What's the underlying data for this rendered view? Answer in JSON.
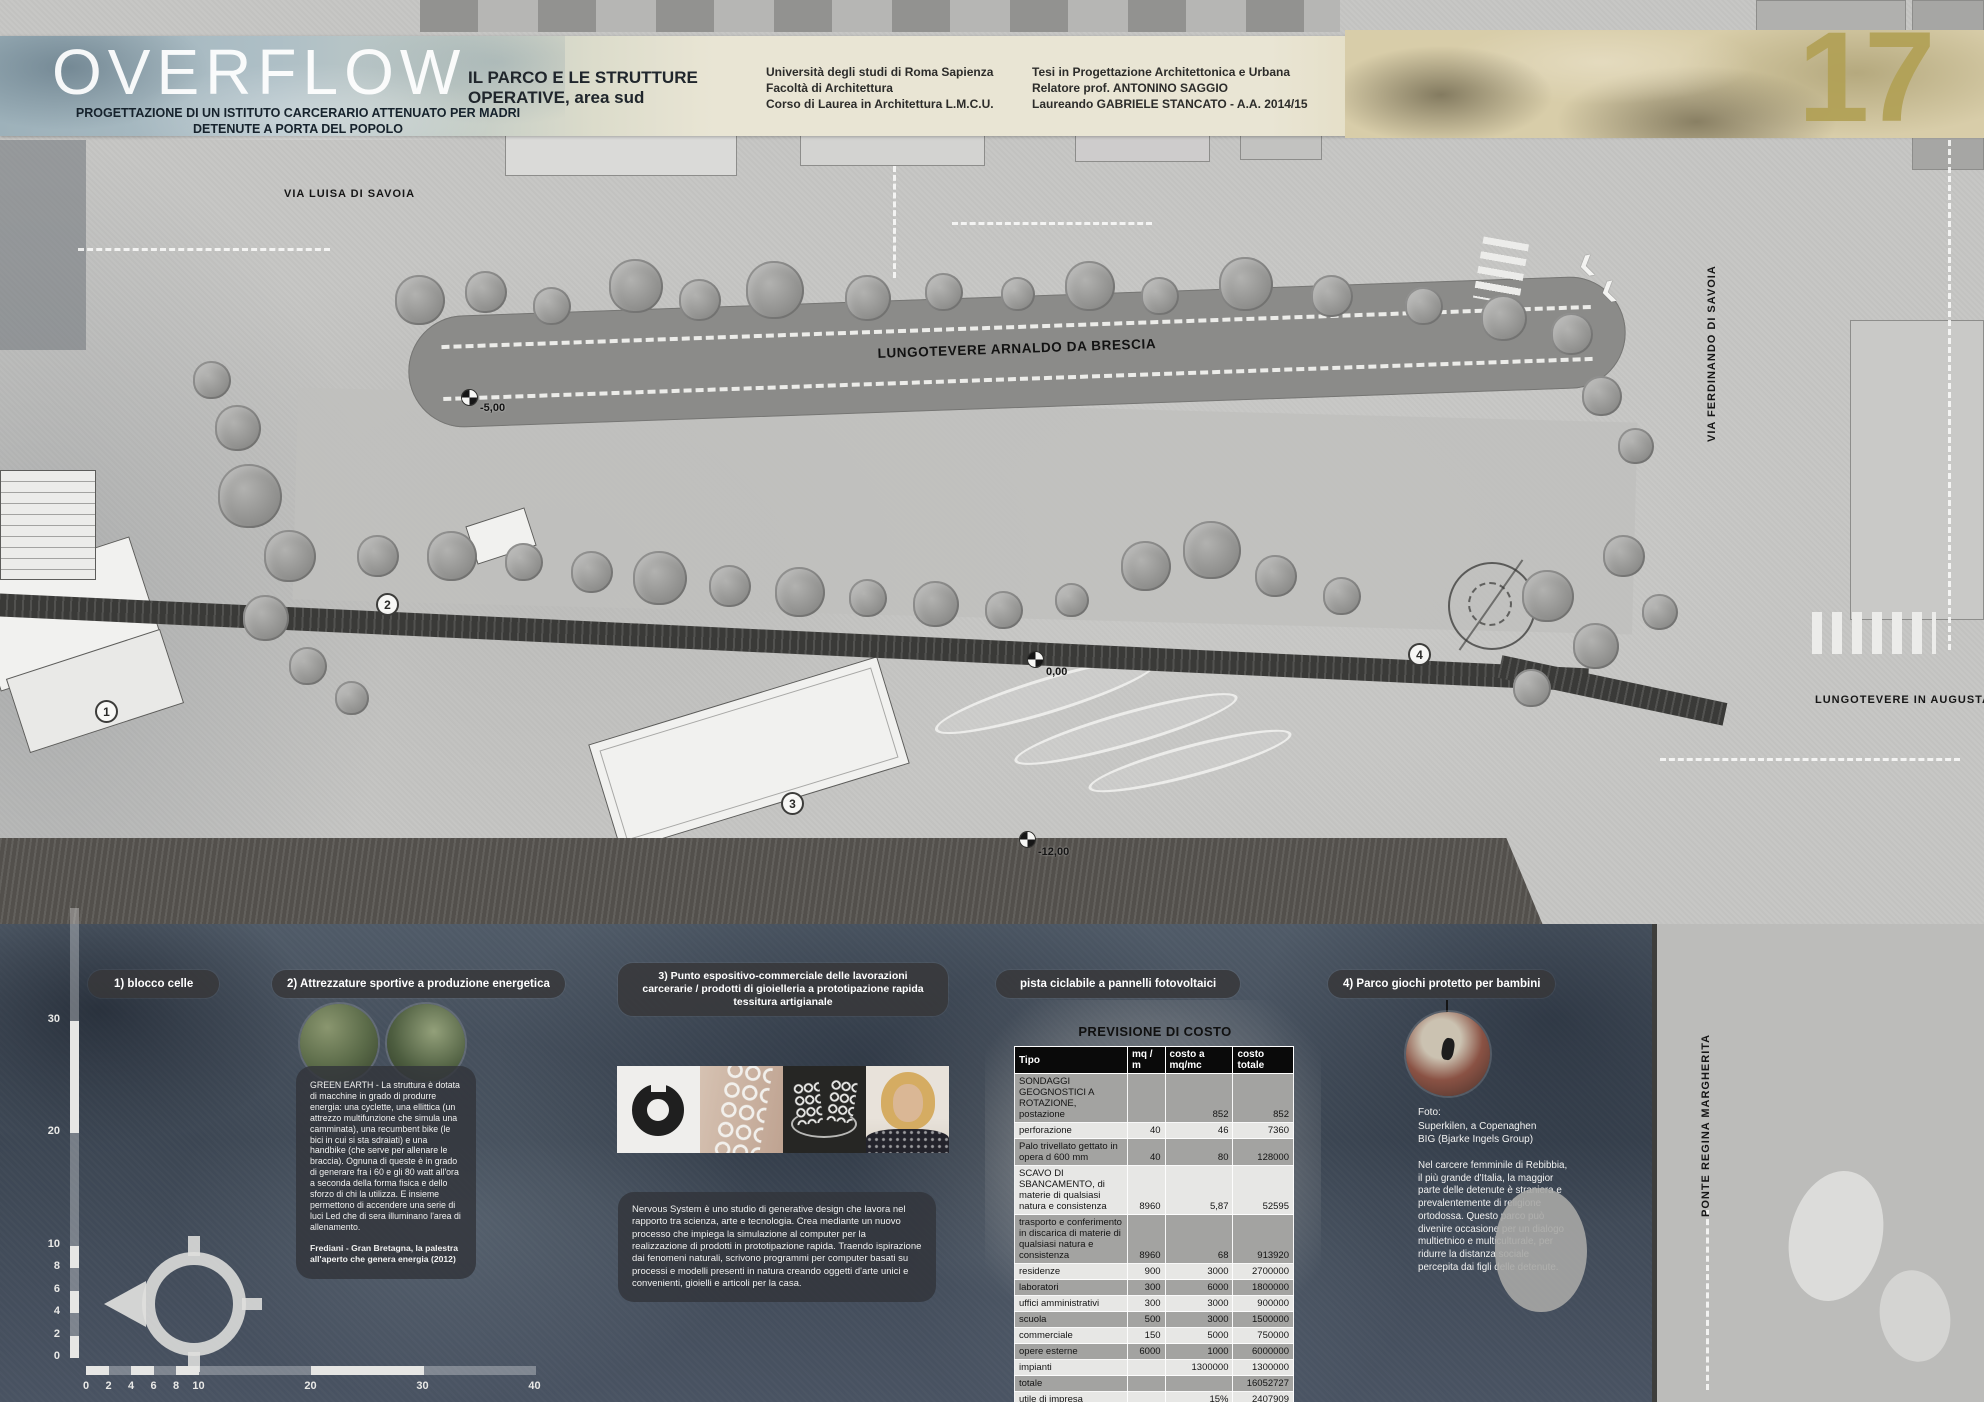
{
  "header": {
    "title": "OVERFLOW",
    "subtitle": "PROGETTAZIONE DI UN ISTITUTO CARCERARIO ATTENUATO PER MADRI DETENUTE A PORTA DEL POPOLO",
    "section_line1": "IL PARCO E LE STRUTTURE",
    "section_line2": "OPERATIVE, area sud",
    "university": [
      "Università degli studi di Roma Sapienza",
      "Facoltà di Architettura",
      "Corso di Laurea in Architettura L.M.C.U."
    ],
    "thesis": [
      "Tesi in Progettazione Architettonica e Urbana",
      "Relatore prof. ANTONINO SAGGIO",
      "Laureando GABRIELE STANCATO - A.A. 2014/15"
    ],
    "page_number": "17",
    "accent_gold": "#b2a156"
  },
  "plan": {
    "streets": {
      "via_luisa": "VIA LUISA DI SAVOIA",
      "lungotevere_brescia": "LUNGOTEVERE ARNALDO DA BRESCIA",
      "via_ferdinando": "VIA FERDINANDO DI SAVOIA",
      "lungotevere_augusta": "LUNGOTEVERE IN AUGUSTA",
      "ponte_regina": "PONTE REGINA MARGHERITA"
    },
    "elevations": [
      {
        "label": "-5,00"
      },
      {
        "label": "0,00"
      },
      {
        "label": "-12,00"
      }
    ],
    "markers": [
      "1",
      "2",
      "3",
      "4"
    ]
  },
  "callouts": {
    "c1": {
      "label": "1) blocco celle"
    },
    "c2": {
      "label": "2) Attrezzature sportive a produzione energetica",
      "body": "GREEN EARTH - La struttura è dotata di macchine in grado di produrre energia: una cyclette, una ellittica (un attrezzo multifunzione che simula una camminata), una recumbent bike (le bici in cui si sta sdraiati) e una handbike (che serve per allenare le braccia). Ognuna di queste è in grado di generare fra i 60 e gli 80 watt all'ora a seconda della forma fisica e dello sforzo di chi la utilizza. E insieme permettono di accendere una serie di luci Led che di sera illuminano l'area di allenamento.",
      "credit": "Frediani - Gran Bretagna, la palestra all'aperto che genera energia (2012)"
    },
    "c3": {
      "label": "3) Punto espositivo-commerciale delle lavorazioni carcerarie / prodotti di gioielleria a prototipazione rapida tessitura artigianale",
      "body": "Nervous System è uno studio di generative design che lavora nel rapporto tra scienza, arte e tecnologia. Crea mediante un nuovo processo che impiega la simulazione al computer per la realizzazione di prodotti in prototipazione rapida. Traendo ispirazione dai fenomeni naturali, scrivono programmi per computer basati su processi e modelli presenti in natura creando oggetti d'arte unici e convenienti, gioielli e articoli per la casa."
    },
    "c_pista": {
      "label": "pista ciclabile a pannelli fotovoltaici"
    },
    "c4": {
      "label": "4) Parco giochi protetto per bambini",
      "photo_credit": [
        "Foto:",
        "Superkilen, a Copenaghen",
        "BIG (Bjarke Ingels Group)"
      ],
      "body": "Nel carcere femminile di Rebibbia, il più grande d'Italia, la maggior parte delle detenute è straniera e prevalentemente di religione ortodossa. Questo parco può divenire occasione per un dialogo multietnico e multiculturale, per ridurre la distanza sociale percepita dai figli delle detenute."
    }
  },
  "cost_table": {
    "title": "PREVISIONE DI COSTO",
    "columns": [
      "Tipo",
      "mq / m",
      "costo  a mq/mc",
      "costo totale"
    ],
    "rows": [
      [
        "SONDAGGI GEOGNOSTICI A ROTAZIONE, postazione",
        "",
        "852",
        "852"
      ],
      [
        "perforazione",
        "40",
        "46",
        "7360"
      ],
      [
        "Palo trivellato gettato in opera d 600 mm",
        "40",
        "80",
        "128000"
      ],
      [
        "SCAVO DI SBANCAMENTO, di materie di qualsiasi natura e consistenza",
        "8960",
        "5,87",
        "52595"
      ],
      [
        "trasporto e conferimento in discarica  di materie di qualsiasi natura e consistenza",
        "8960",
        "68",
        "913920"
      ],
      [
        "residenze",
        "900",
        "3000",
        "2700000"
      ],
      [
        "laboratori",
        "300",
        "6000",
        "1800000"
      ],
      [
        "uffici amministrativi",
        "300",
        "3000",
        "900000"
      ],
      [
        "scuola",
        "500",
        "3000",
        "1500000"
      ],
      [
        "commerciale",
        "150",
        "5000",
        "750000"
      ],
      [
        "opere esterne",
        "6000",
        "1000",
        "6000000"
      ],
      [
        "impianti",
        "",
        "1300000",
        "1300000"
      ],
      [
        "totale",
        "",
        "",
        "16052727"
      ],
      [
        "utile di impresa",
        "",
        "15%",
        "2407909"
      ],
      [
        "oneri di ingegneria",
        "",
        "12%",
        "1926327"
      ],
      [
        "",
        "",
        "",
        ""
      ],
      [
        "costo complessivo",
        "",
        "",
        "20386964"
      ]
    ]
  },
  "scales": {
    "h_labels": [
      "0",
      "2",
      "4",
      "6",
      "8",
      "10",
      "20",
      "30",
      "40"
    ],
    "v_labels": [
      "30",
      "20",
      "10",
      "8",
      "6",
      "4",
      "2",
      "0"
    ]
  }
}
